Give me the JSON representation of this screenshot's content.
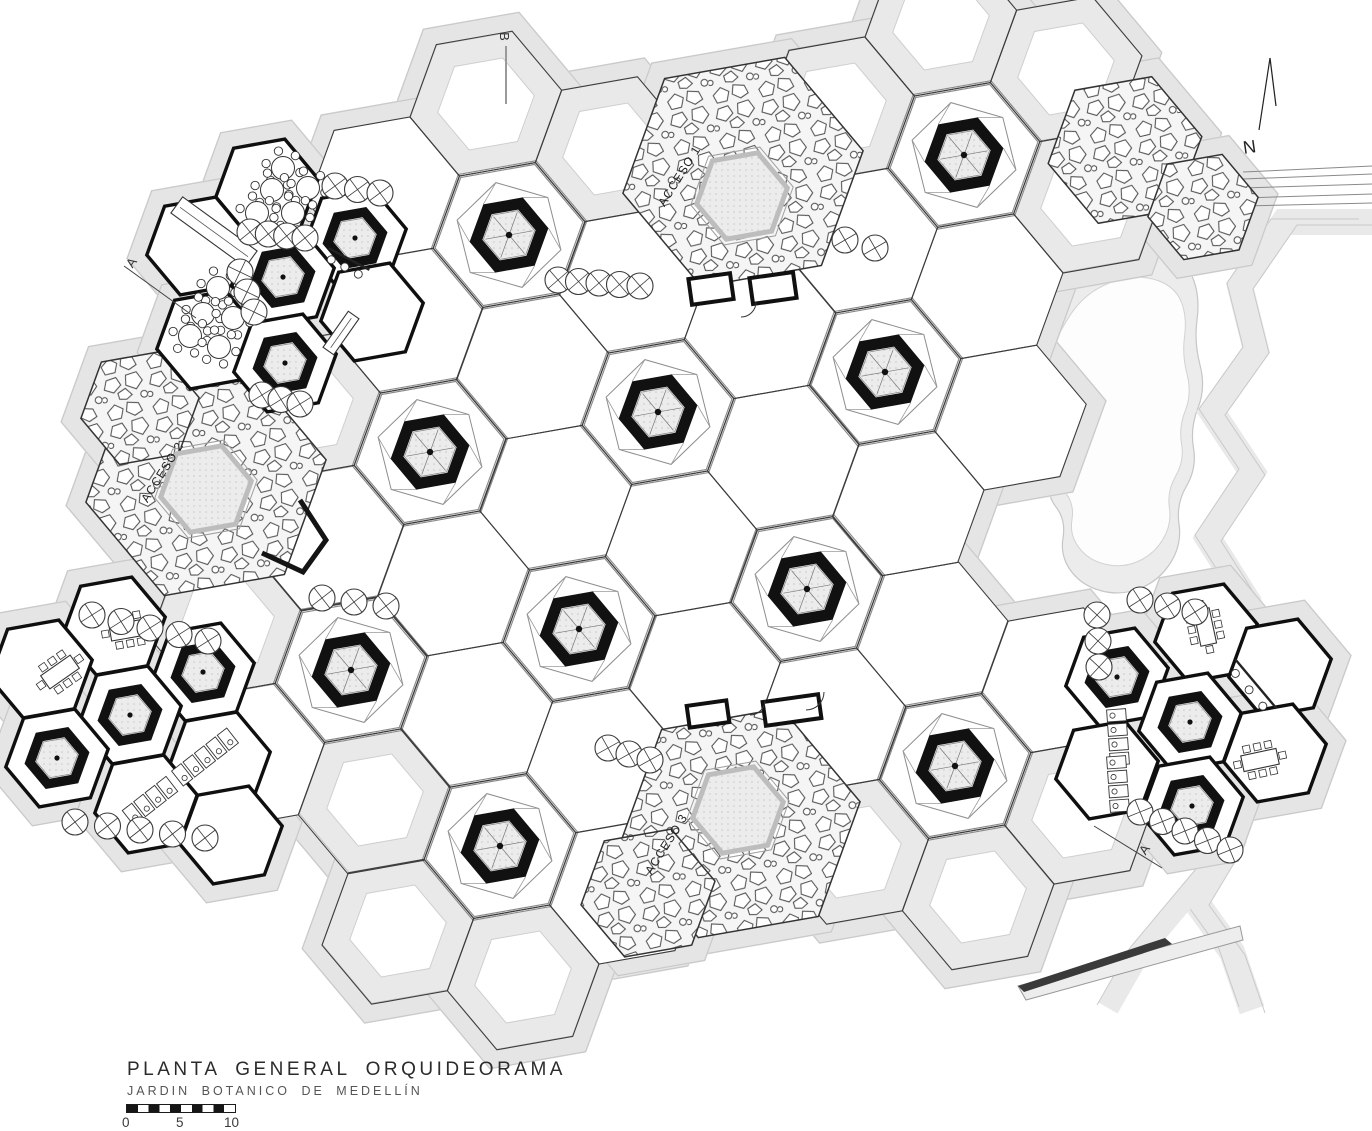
{
  "title_block": {
    "title": "PLANTA GENERAL ORQUIDEORAMA",
    "subtitle": "JARDIN BOTANICO DE MEDELLÍN",
    "scale_labels": [
      "0",
      "5",
      "10"
    ]
  },
  "north": {
    "label": "N"
  },
  "section_markers": {
    "b": "B",
    "a_left": "A",
    "a_right": "A"
  },
  "access": {
    "labels": [
      {
        "text": "ACCESO 1"
      },
      {
        "text": "ACCESO 2"
      },
      {
        "text": "ACCESO 3"
      }
    ]
  },
  "colors": {
    "line": "#3c3c3c",
    "ink": "#111111",
    "light_line": "#c9c9c9",
    "band": "#e5e5e5",
    "paper": "#ffffff",
    "stone_stroke": "#333333",
    "pad_fill": "#ececec",
    "water_band": "#ececec"
  },
  "plan": {
    "rotation": -10,
    "cell_radius": 77,
    "cell_offsets": [
      [
        125.4,
        45.6
      ],
      [
        102.2,
        -85.8
      ],
      [
        -23.2,
        -131.4
      ],
      [
        -125.4,
        -45.6
      ],
      [
        -102.2,
        85.8
      ],
      [
        23.2,
        131.4
      ]
    ],
    "trunks_main": [
      [
        658,
        412
      ],
      [
        885,
        372
      ],
      [
        807,
        589
      ],
      [
        579,
        629
      ],
      [
        430,
        452
      ],
      [
        509,
        235
      ],
      [
        964,
        155
      ],
      [
        351,
        670
      ],
      [
        500,
        846
      ],
      [
        955,
        766
      ]
    ],
    "banded_cells": [
      [
        486,
        104
      ],
      [
        611,
        149
      ],
      [
        838,
        109
      ],
      [
        941,
        24
      ],
      [
        1066,
        69
      ],
      [
        523,
        977
      ],
      [
        398,
        931
      ],
      [
        978,
        897
      ],
      [
        853,
        852
      ],
      [
        375,
        800
      ],
      [
        305,
        407
      ],
      [
        1089,
        200
      ],
      [
        1080,
        812
      ],
      [
        226,
        625
      ]
    ],
    "stones": [
      [
        743,
        172,
        122
      ],
      [
        206,
        481,
        122
      ],
      [
        740,
        823,
        122
      ],
      [
        1125,
        150,
        78
      ],
      [
        1203,
        207,
        56
      ],
      [
        648,
        893,
        68
      ],
      [
        140,
        408,
        60
      ]
    ],
    "pads": [
      [
        742,
        196,
        46
      ],
      [
        206,
        489,
        46
      ],
      [
        738,
        810,
        46
      ]
    ],
    "pavilion_radius": 52,
    "pavilion_hexes": [
      [
        267,
        188
      ],
      [
        355,
        238
      ],
      [
        198,
        246
      ],
      [
        283,
        277
      ],
      [
        372,
        312
      ],
      [
        208,
        340
      ],
      [
        285,
        363
      ],
      [
        114,
        626
      ],
      [
        41,
        669
      ],
      [
        203,
        672
      ],
      [
        130,
        715
      ],
      [
        57,
        758
      ],
      [
        219,
        761
      ],
      [
        146,
        804
      ],
      [
        231,
        835
      ],
      [
        1206,
        633
      ],
      [
        1280,
        668
      ],
      [
        1117,
        677
      ],
      [
        1190,
        722
      ],
      [
        1275,
        753
      ],
      [
        1107,
        770
      ],
      [
        1192,
        806
      ]
    ],
    "trunks_small": [
      [
        355,
        238
      ],
      [
        283,
        277
      ],
      [
        285,
        363
      ],
      [
        203,
        672
      ],
      [
        130,
        715
      ],
      [
        57,
        758
      ],
      [
        1117,
        677
      ],
      [
        1190,
        722
      ],
      [
        1192,
        806
      ]
    ],
    "chains": [
      [
        250,
        232,
        305,
        238,
        4
      ],
      [
        335,
        186,
        380,
        193,
        3
      ],
      [
        240,
        272,
        254,
        312,
        3
      ],
      [
        262,
        395,
        300,
        404,
        3
      ],
      [
        558,
        280,
        640,
        286,
        5
      ],
      [
        845,
        240,
        875,
        248,
        2
      ],
      [
        92,
        615,
        208,
        641,
        5
      ],
      [
        75,
        822,
        205,
        838,
        5
      ],
      [
        322,
        598,
        386,
        606,
        3
      ],
      [
        1097,
        615,
        1099,
        667,
        3
      ],
      [
        1140,
        812,
        1230,
        850,
        5
      ],
      [
        608,
        748,
        650,
        760,
        3
      ],
      [
        1140,
        600,
        1195,
        612,
        3
      ]
    ],
    "chain_circle_radius": 13,
    "round_tables": [
      [
        283,
        168
      ],
      [
        272,
        190
      ],
      [
        308,
        188
      ],
      [
        257,
        213
      ],
      [
        293,
        213
      ],
      [
        218,
        288
      ],
      [
        203,
        314
      ],
      [
        233,
        318
      ],
      [
        190,
        336
      ],
      [
        219,
        347
      ]
    ],
    "rect_tables": [
      [
        128,
        630,
        -10
      ],
      [
        60,
        672,
        -35
      ],
      [
        1205,
        627,
        78
      ],
      [
        1260,
        760,
        -12
      ]
    ],
    "bars": [
      [
        1256,
        684,
        50,
        64
      ],
      [
        349,
        259,
        28,
        46
      ]
    ],
    "counters": [
      [
        214,
        232,
        36,
        92,
        20
      ],
      [
        341,
        333,
        -55,
        44,
        13
      ]
    ],
    "stall_rows": [
      [
        205,
        757,
        -38,
        5
      ],
      [
        150,
        801,
        -38,
        4
      ],
      [
        1118,
        737,
        86,
        4
      ],
      [
        1118,
        784,
        86,
        4
      ]
    ],
    "kiosks": [
      [
        711,
        289,
        42,
        26,
        -8
      ],
      [
        773,
        288,
        44,
        26,
        -8
      ],
      [
        708,
        714,
        40,
        22,
        -8
      ],
      [
        792,
        710,
        56,
        24,
        -8
      ]
    ],
    "door_arcs": [
      [
        741,
        302,
        15
      ],
      [
        750,
        700,
        15
      ],
      [
        806,
        692,
        18
      ]
    ],
    "wall_paths": [
      [
        [
          300,
          500
        ],
        [
          326,
          540
        ],
        [
          303,
          572
        ],
        [
          262,
          553
        ]
      ]
    ],
    "pond_outer": [
      [
        1044,
        322
      ],
      [
        1072,
        276
      ],
      [
        1112,
        252
      ],
      [
        1155,
        248
      ],
      [
        1188,
        264
      ],
      [
        1200,
        298
      ],
      [
        1194,
        342
      ],
      [
        1206,
        388
      ],
      [
        1190,
        428
      ],
      [
        1197,
        468
      ],
      [
        1176,
        504
      ],
      [
        1182,
        544
      ],
      [
        1160,
        580
      ],
      [
        1122,
        596
      ],
      [
        1082,
        586
      ],
      [
        1060,
        556
      ],
      [
        1066,
        520
      ],
      [
        1046,
        494
      ],
      [
        1052,
        458
      ],
      [
        1036,
        430
      ],
      [
        1046,
        394
      ],
      [
        1032,
        362
      ]
    ],
    "zigzag": [
      [
        1372,
        222
      ],
      [
        1284,
        222
      ],
      [
        1240,
        286
      ],
      [
        1256,
        350
      ],
      [
        1212,
        412
      ],
      [
        1252,
        472
      ],
      [
        1208,
        538
      ],
      [
        1246,
        598
      ],
      [
        1202,
        660
      ],
      [
        1238,
        720
      ],
      [
        1196,
        782
      ],
      [
        1232,
        842
      ],
      [
        1196,
        902
      ],
      [
        1232,
        952
      ],
      [
        1252,
        1010
      ]
    ],
    "zigzag_branch": [
      [
        1232,
        842
      ],
      [
        1140,
        952
      ],
      [
        1108,
        1008
      ]
    ],
    "roads": [
      [
        1243,
        172,
        1372,
        166
      ],
      [
        1243,
        179,
        1372,
        174
      ],
      [
        1243,
        188,
        1372,
        184
      ],
      [
        1243,
        198,
        1372,
        194
      ],
      [
        1243,
        206,
        1372,
        203
      ]
    ],
    "bottom_path": [
      [
        1018,
        986
      ],
      [
        1240,
        926
      ],
      [
        1243,
        940
      ],
      [
        1026,
        1000
      ]
    ],
    "dark_wedge": [
      [
        1018,
        986
      ],
      [
        1165,
        938
      ],
      [
        1172,
        944
      ],
      [
        1024,
        992
      ]
    ],
    "north_lines": [
      [
        1259,
        130,
        1270,
        58
      ],
      [
        1270,
        58,
        1276,
        106
      ]
    ],
    "marker_lines": [
      [
        506,
        46,
        506,
        104
      ],
      [
        124,
        266,
        196,
        318
      ],
      [
        1094,
        826,
        1162,
        868
      ]
    ]
  }
}
